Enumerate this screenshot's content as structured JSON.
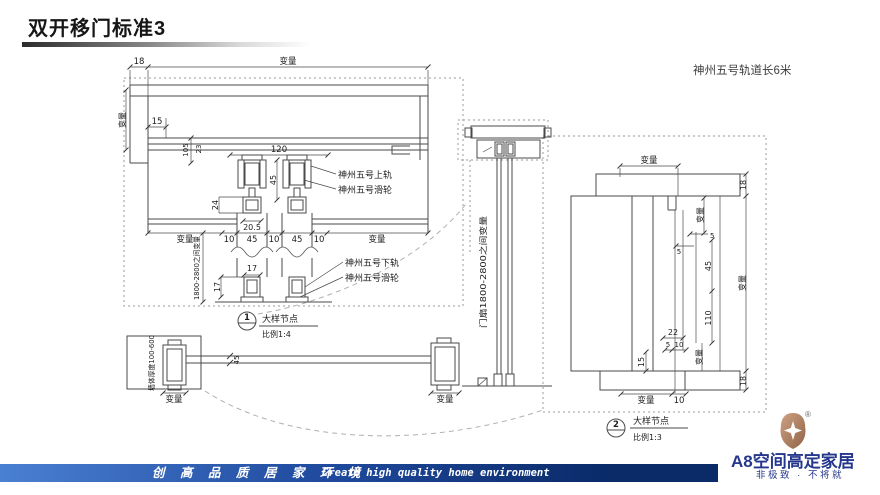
{
  "header": {
    "title": "双开移门标准3"
  },
  "note": {
    "text": "神州五号轨道长6米"
  },
  "drawing": {
    "plan": {
      "dim_18": "18",
      "dim_var_top": "变量",
      "dim_var_left": "变量",
      "dim_15": "15",
      "dim_105": "105",
      "dim_23": "23",
      "dim_120": "120",
      "dim_45_roller": "45",
      "dim_24": "24",
      "dim_20_5": "20.5",
      "label_upper_track": "神州五号上轨",
      "label_upper_roller": "神州五号滑轮",
      "dim_row": [
        "变量",
        "10",
        "45",
        "10",
        "45",
        "10",
        "变量"
      ],
      "dim_height_range": "1800-2800之间变量",
      "dim_17_w": "17",
      "dim_17_h": "17",
      "label_lower_track": "神州五号下轨",
      "label_lower_roller": "神州五号滑轮",
      "detail": {
        "no": "1",
        "title": "大样节点",
        "scale": "比例1:4"
      }
    },
    "elevation": {
      "dim_door_range": "门扇1800-2800之间变量"
    },
    "wall_plan": {
      "label_wall_thickness": "墙体厚度100-600",
      "dim_var_wall": "变量",
      "dim_45": "45",
      "dim_var_post": "变量"
    },
    "section": {
      "dim_var_top": "变量",
      "dim_18_top": "18",
      "dim_var_a": "变量",
      "dim_5_a": "5",
      "dim_5_b": "5",
      "dim_45": "45",
      "dim_110": "110",
      "dim_var_right": "变量",
      "dim_22": "22",
      "dim_5_c": "5",
      "dim_10_a": "10",
      "dim_15": "15",
      "dim_var_c": "变量",
      "dim_18_bottom": "18",
      "dim_var_bottom": "变量",
      "dim_10_b": "10",
      "detail": {
        "no": "2",
        "title": "大样节点",
        "scale": "比例1:3"
      }
    }
  },
  "footer": {
    "slogan_cn": "创 高 品 质 居 家 环 境",
    "slogan_en": "Create high quality home environment"
  },
  "brand": {
    "name": "A8空间高定家居",
    "tagline": "非极致 · 不将就",
    "reg": "®"
  },
  "colors": {
    "footer_left": "#4a80d2",
    "footer_right": "#0a2a68",
    "brand_navy": "#24378c",
    "logo_bronze": "#b9876a"
  }
}
